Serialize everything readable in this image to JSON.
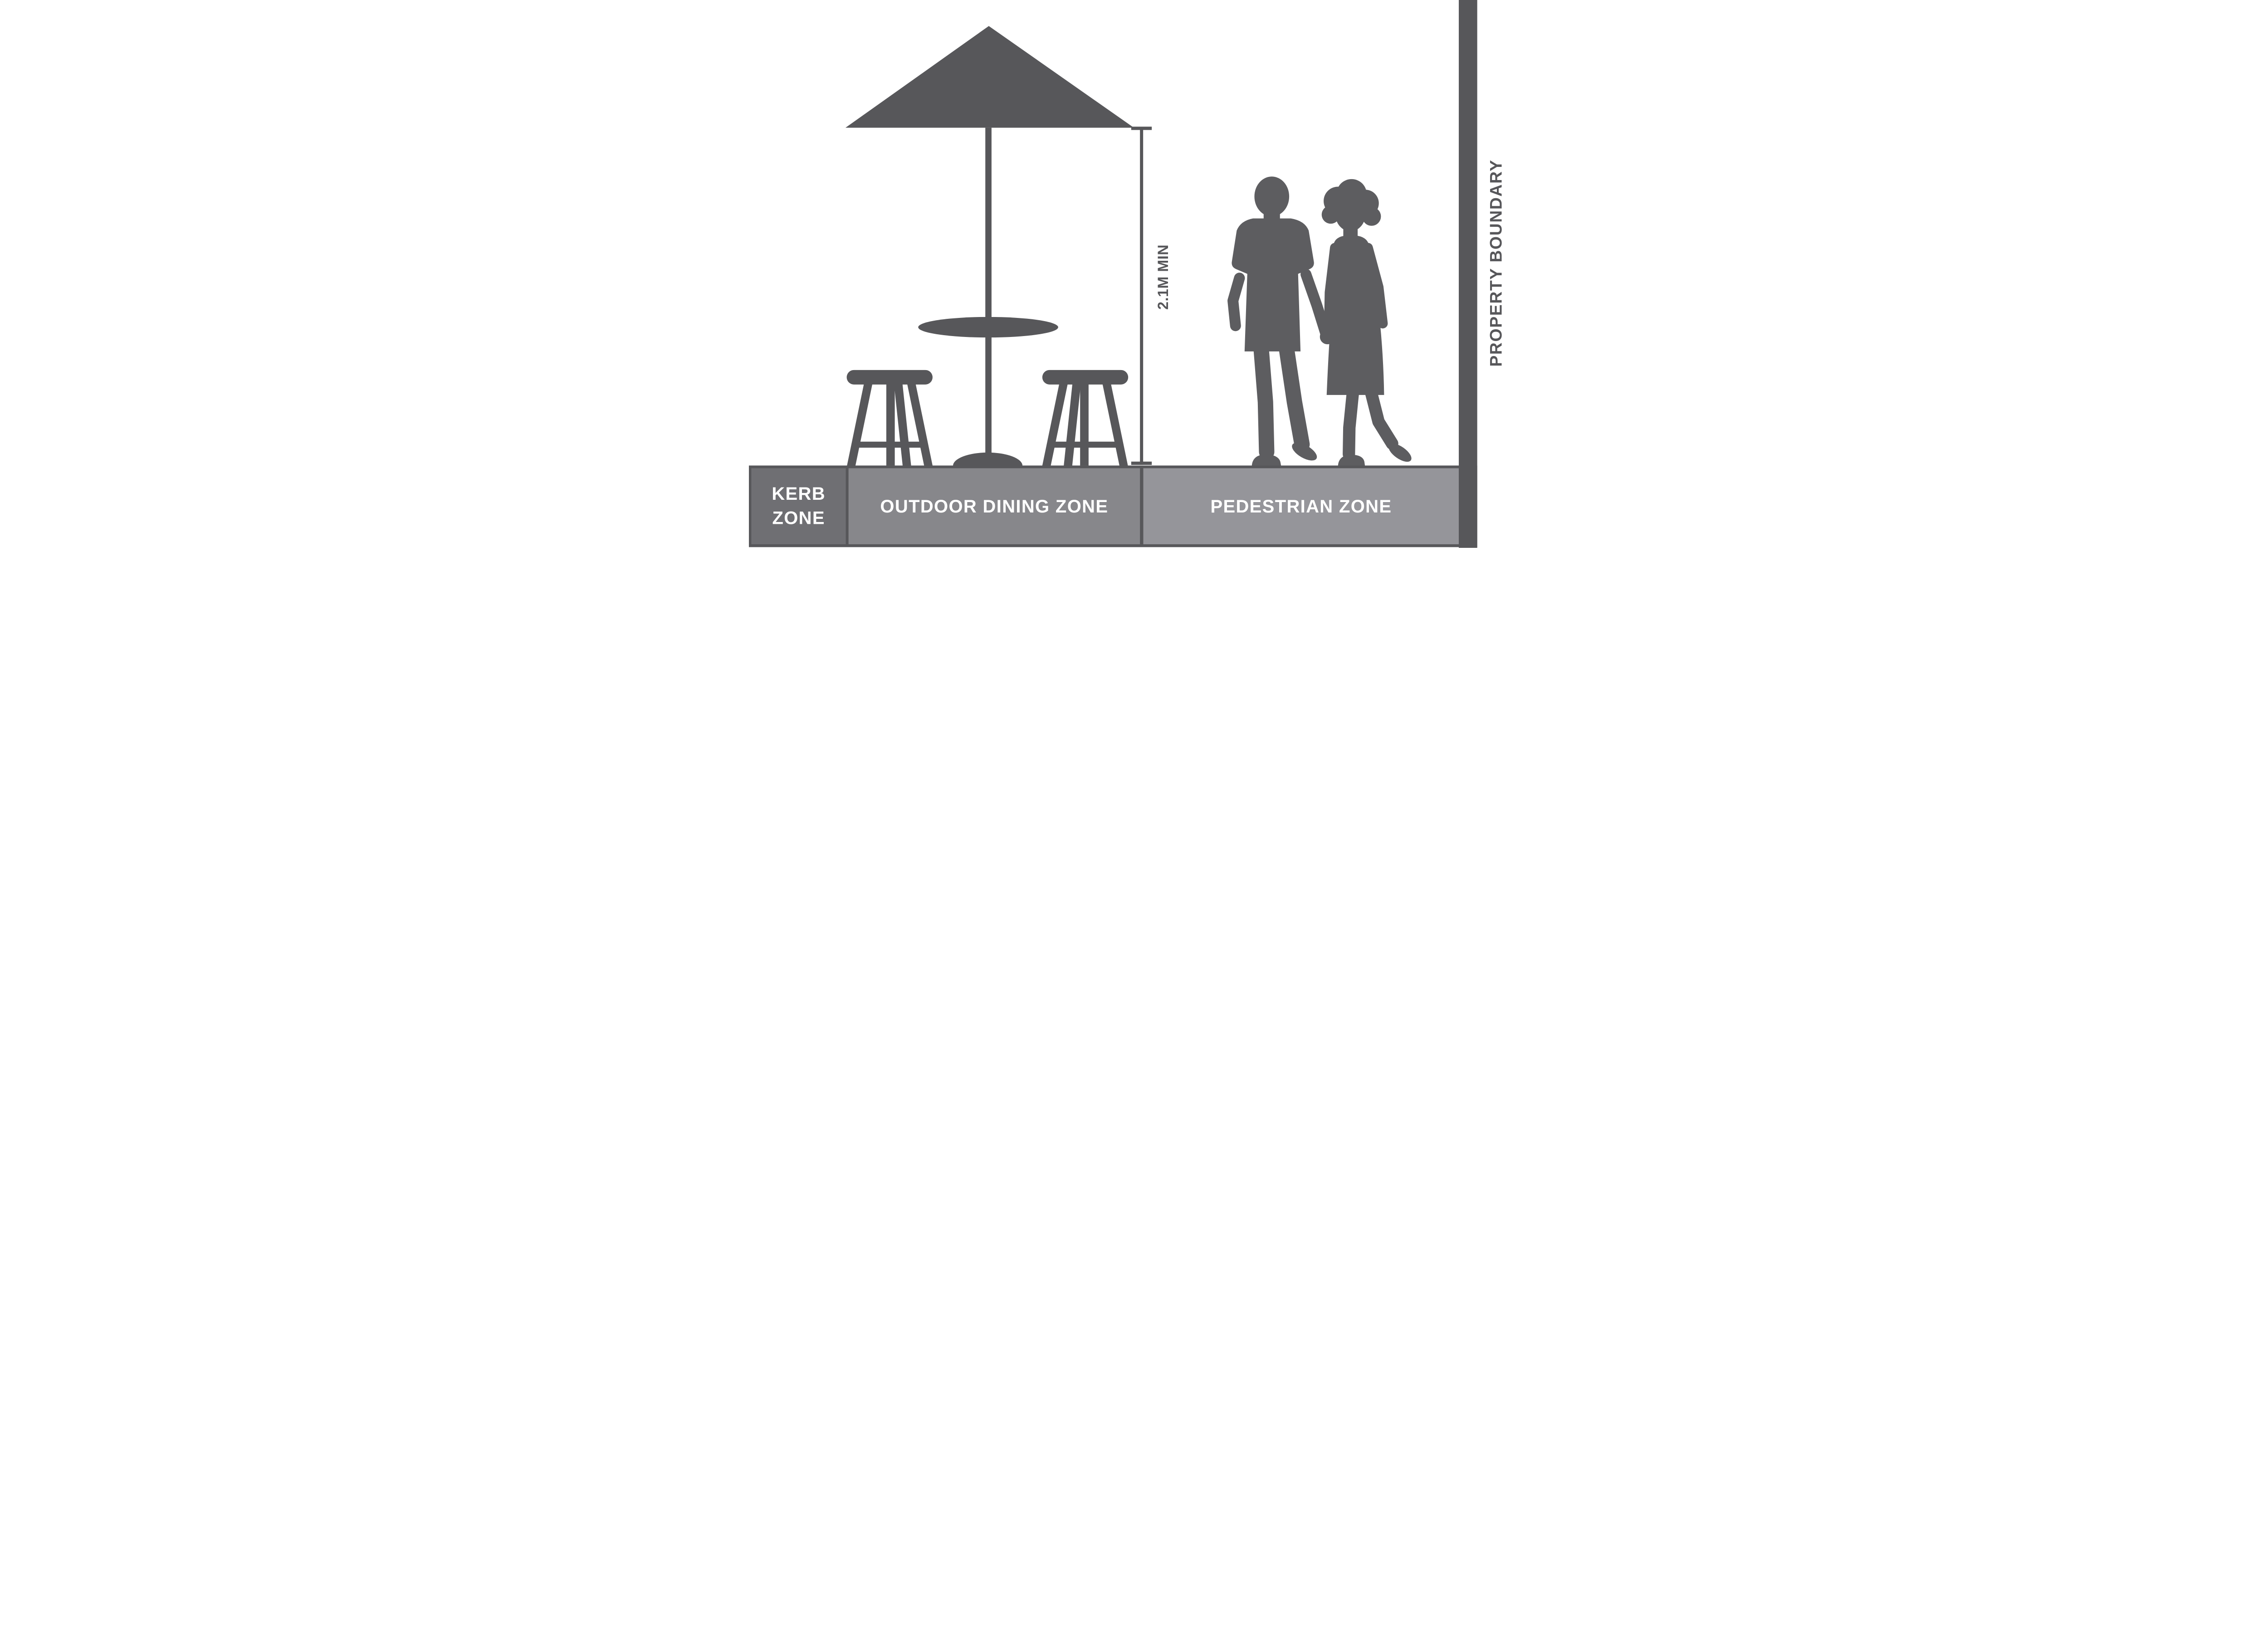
{
  "colors": {
    "dark": "#57575a",
    "kerb_panel": "#6f6f73",
    "dining_panel": "#87878b",
    "pedestrian_panel": "#95959a",
    "figure": "#5d5d60",
    "label_text": "#ffffff",
    "background": "#ffffff"
  },
  "zones": {
    "kerb": {
      "lines": [
        "KERB",
        "ZONE"
      ]
    },
    "dining": {
      "label": "OUTDOOR DINING ZONE"
    },
    "pedestrian": {
      "label": "PEDESTRIAN ZONE"
    }
  },
  "dimension": {
    "label": "2.1M MIN"
  },
  "property_boundary": {
    "label": "PROPERTY BOUNDARY"
  }
}
